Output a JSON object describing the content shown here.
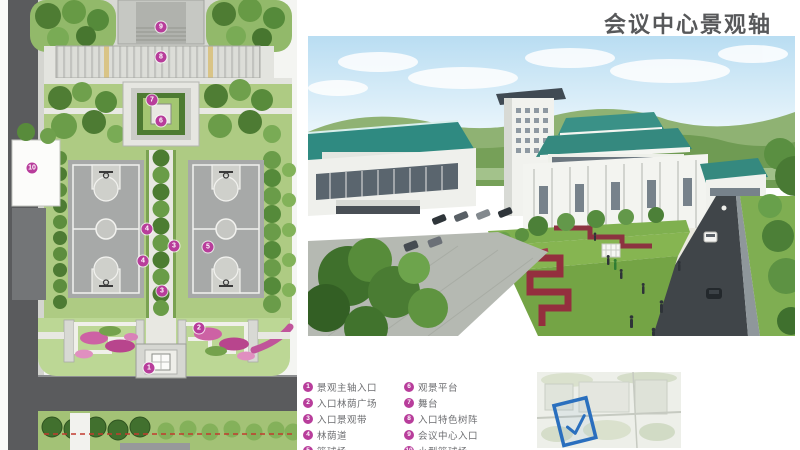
{
  "title": "会议中心景观轴",
  "colors": {
    "marker_magenta": "#b83d9b",
    "title_gray": "#57585a",
    "legend_text": "#6d6e71",
    "highlight_blue": "#2a6fbe",
    "boundary_red_dash": "#c23b2e",
    "roof_teal": "#2f8a81",
    "flower_pink": "#cd62a4"
  },
  "legend": {
    "items": [
      {
        "num": "1",
        "label": "景观主轴入口"
      },
      {
        "num": "2",
        "label": "入口林荫广场"
      },
      {
        "num": "3",
        "label": "入口景观带"
      },
      {
        "num": "4",
        "label": "林荫道"
      },
      {
        "num": "5",
        "label": "篮球场"
      },
      {
        "num": "6",
        "label": "观景平台"
      },
      {
        "num": "7",
        "label": "舞台"
      },
      {
        "num": "8",
        "label": "入口特色树阵"
      },
      {
        "num": "9",
        "label": "会议中心入口"
      },
      {
        "num": "10",
        "label": "小型篮球场"
      }
    ]
  },
  "site_plan": {
    "markers": [
      {
        "num": "9",
        "x": 161,
        "y": 27
      },
      {
        "num": "8",
        "x": 161,
        "y": 57
      },
      {
        "num": "7",
        "x": 152,
        "y": 100
      },
      {
        "num": "6",
        "x": 161,
        "y": 121
      },
      {
        "num": "10",
        "x": 32,
        "y": 168
      },
      {
        "num": "4",
        "x": 147,
        "y": 229
      },
      {
        "num": "3",
        "x": 174,
        "y": 246
      },
      {
        "num": "5",
        "x": 208,
        "y": 247
      },
      {
        "num": "4",
        "x": 143,
        "y": 261
      },
      {
        "num": "3",
        "x": 162,
        "y": 291
      },
      {
        "num": "2",
        "x": 199,
        "y": 328
      },
      {
        "num": "1",
        "x": 149,
        "y": 368
      }
    ]
  },
  "keymap": {
    "check": "✓"
  }
}
